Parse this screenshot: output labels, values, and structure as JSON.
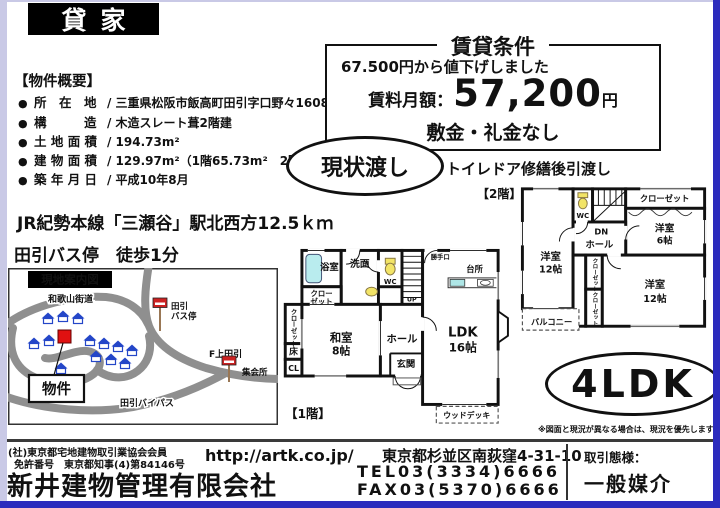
{
  "header": {
    "title": "貸家"
  },
  "overview": {
    "heading": "【物件概要】",
    "bullet": "●",
    "rows": [
      {
        "label": "所　在　地",
        "value": "/ 三重県松阪市飯高町田引字口野々1608番3"
      },
      {
        "label": "構　　　造",
        "value": "/ 木造スレート葺2階建"
      },
      {
        "label": "土 地 面 積",
        "value": "/ 194.73m²"
      },
      {
        "label": "建 物 面 積",
        "value": "/ 129.97m²（1階65.73m²　2階64.24m²）"
      },
      {
        "label": "築 年 月 日",
        "value": "/ 平成10年8月"
      }
    ]
  },
  "conditions": {
    "title": "賃貸条件",
    "discount": "67.500円から値下げしました",
    "rent_label": "賃料月額：",
    "rent_amount": "57,200",
    "rent_unit": "円",
    "deposit": "敷金・礼金なし",
    "as_is": "現状渡し",
    "handover": "トイレドア修繕後引渡し"
  },
  "access": {
    "train": "JR紀勢本線「三瀬谷」駅北西方12.5ｋｍ",
    "bus": "田引バス停　徒歩1分"
  },
  "map": {
    "title": "現地案内図",
    "road_wakayama": "和歌山街道",
    "bus_stop_l1": "田引",
    "bus_stop_l2": "バス停",
    "f_kamitabiki": "F上田引",
    "meeting_hall": "集会所",
    "property": "物件",
    "bypass": "田引バイパス"
  },
  "floor1": {
    "label": "【1階】",
    "rooms": {
      "bath": "浴室",
      "wash": "洗面",
      "wc": "WC",
      "closet_l1": "クロー",
      "closet_l2": "ゼット",
      "closet_v": "クローゼット",
      "toko": "床",
      "cl": "CL",
      "washitsu_l1": "和室",
      "washitsu_l2": "8帖",
      "hall": "ホール",
      "genkan": "玄関",
      "up": "UP",
      "katteguchi": "勝手口",
      "kitchen": "台所",
      "ldk_l1": "LDK",
      "ldk_l2": "16帖",
      "wood_deck": "ウッドデッキ"
    }
  },
  "floor2": {
    "label": "【2階】",
    "rooms": {
      "wc": "WC",
      "dn": "DN",
      "hall": "ホール",
      "closet_top": "クローゼット",
      "room6_l1": "洋室",
      "room6_l2": "6帖",
      "room12a_l1": "洋室",
      "room12a_l2": "12帖",
      "room12b_l1": "洋室",
      "room12b_l2": "12帖",
      "closet_mid1": "クローゼット",
      "closet_mid2": "クローゼット",
      "balcony": "バルコニー"
    }
  },
  "layout_badge": "4LDK",
  "disclaimer": "※図面と現況が異なる場合は、現況を優先します",
  "footer": {
    "membership": "(社)東京都宅地建物取引業協会会員",
    "license": "免許番号　東京都知事(4)第84146号",
    "company": "新井建物管理有限会社",
    "url": "http://artk.co.jp/",
    "address": "東京都杉並区南荻窪4-31-10",
    "tel": "TEL03(3334)6666",
    "fax": "FAX03(5370)6666",
    "deal_label": "取引態様：",
    "deal_type": "一般媒介"
  },
  "colors": {
    "border_blue": "#2b2bbd",
    "border_lavender": "#c9c9e6",
    "marker_red": "#e01111",
    "house_blue": "#2446c8"
  }
}
